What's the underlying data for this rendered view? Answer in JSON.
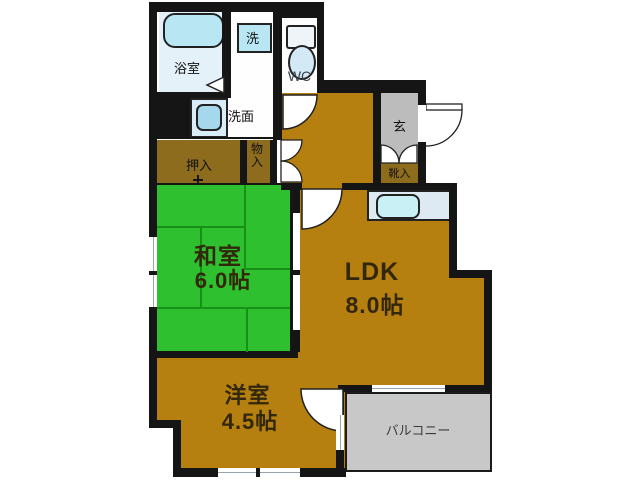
{
  "floorplan": {
    "rooms": {
      "ldk": {
        "label": "LDK",
        "size": "8.0帖"
      },
      "washitsu": {
        "label": "和室",
        "size": "6.0帖"
      },
      "yoshitsu": {
        "label": "洋室",
        "size": "4.5帖"
      },
      "balcony": {
        "label": "バルコニー"
      },
      "bathroom": {
        "label": "浴室"
      },
      "washstand": {
        "label": "洗面"
      },
      "laundry": {
        "label": "洗"
      },
      "wc": {
        "label": "WC"
      },
      "genkan": {
        "label": "玄"
      },
      "oshiire": {
        "label": "押入"
      },
      "monoire": {
        "label": "物入"
      },
      "shoebox": {
        "label": "靴入"
      }
    },
    "colors": {
      "wall": "#151515",
      "floor_brown": "#b5800f",
      "closet_brown": "#8d6c1e",
      "tatami_green": "#2fc02f",
      "tatami_line": "#169016",
      "genkan_gray": "#bcbcbc",
      "balcony_gray": "#c8c8c8",
      "bath_blue": "#e4f1f8",
      "fixture_blue": "#b8e7f3",
      "sink_blue": "#a9dcec"
    }
  }
}
